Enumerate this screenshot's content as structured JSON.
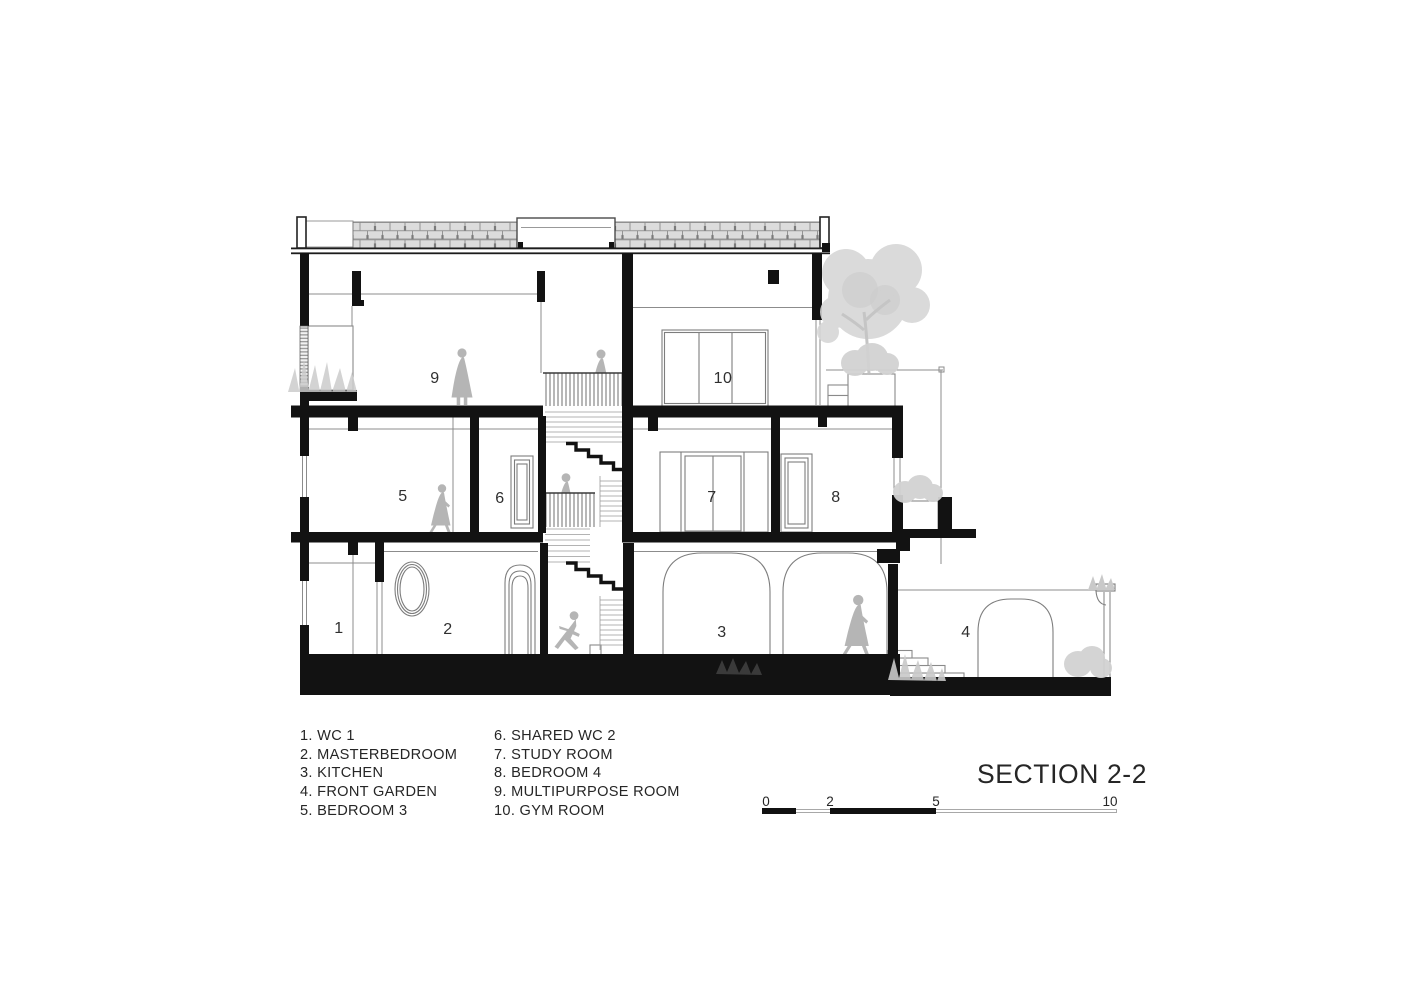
{
  "title": "SECTION 2-2",
  "rooms": [
    {
      "num": "1",
      "name": "WC 1"
    },
    {
      "num": "2",
      "name": "MASTERBEDROOM"
    },
    {
      "num": "3",
      "name": "KITCHEN"
    },
    {
      "num": "4",
      "name": "FRONT GARDEN"
    },
    {
      "num": "5",
      "name": "BEDROOM 3"
    },
    {
      "num": "6",
      "name": "SHARED WC 2"
    },
    {
      "num": "7",
      "name": "STUDY ROOM"
    },
    {
      "num": "8",
      "name": "BEDROOM 4"
    },
    {
      "num": "9",
      "name": "MULTIPURPOSE ROOM"
    },
    {
      "num": "10",
      "name": "GYM ROOM"
    }
  ],
  "legend": {
    "col1": [
      "1. WC 1",
      "2. MASTERBEDROOM",
      "3. KITCHEN",
      "4. FRONT GARDEN",
      "5. BEDROOM 3"
    ],
    "col2": [
      "6. SHARED WC 2",
      "7. STUDY ROOM",
      "8. BEDROOM 4",
      "9. MULTIPURPOSE ROOM",
      "10. GYM ROOM"
    ]
  },
  "scale_bar": {
    "labels": [
      "0",
      "2",
      "5",
      "10"
    ]
  },
  "colors": {
    "ink": "#121212",
    "thin_line": "#8c8c8c",
    "figure": "#b5b5b5",
    "vegetation": "#cfcfcf",
    "brick_fill": "#dcdcdc",
    "brick_joint": "#949494"
  }
}
